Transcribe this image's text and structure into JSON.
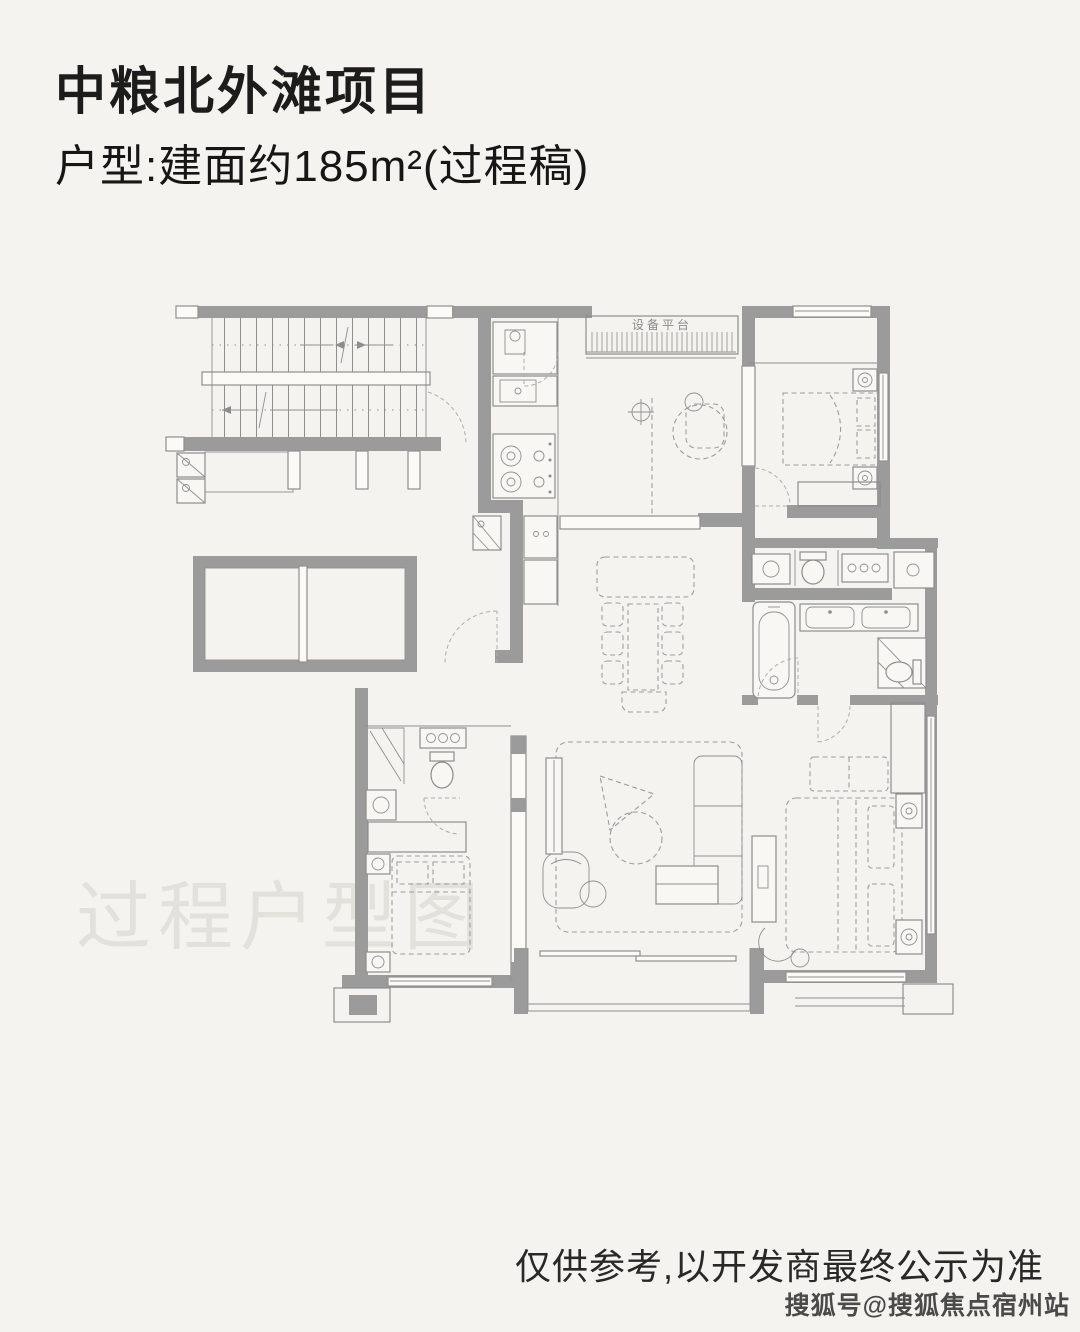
{
  "colors": {
    "background": "#f4f3ef",
    "wall_gray": "#9b9b9b",
    "line_gray": "#8d8d8d",
    "dashed_furniture_gray": "#9d9d9d",
    "title_black": "#1c1c1c",
    "plan_watermark_gray": "#e3e1dc",
    "disclaimer_dark": "#282828",
    "sohu_watermark_gray": "#4a4a4a"
  },
  "header": {
    "title": "中粮北外滩项目",
    "subtitle": "户型:建面约185m²(过程稿)"
  },
  "floorplan": {
    "watermark": "过程户型图",
    "labels": {
      "equipment_platform": "设备平台"
    }
  },
  "footer": {
    "disclaimer": "仅供参考,以开发商最终公示为准",
    "sohu_watermark": "搜狐号@搜狐焦点宿州站"
  }
}
